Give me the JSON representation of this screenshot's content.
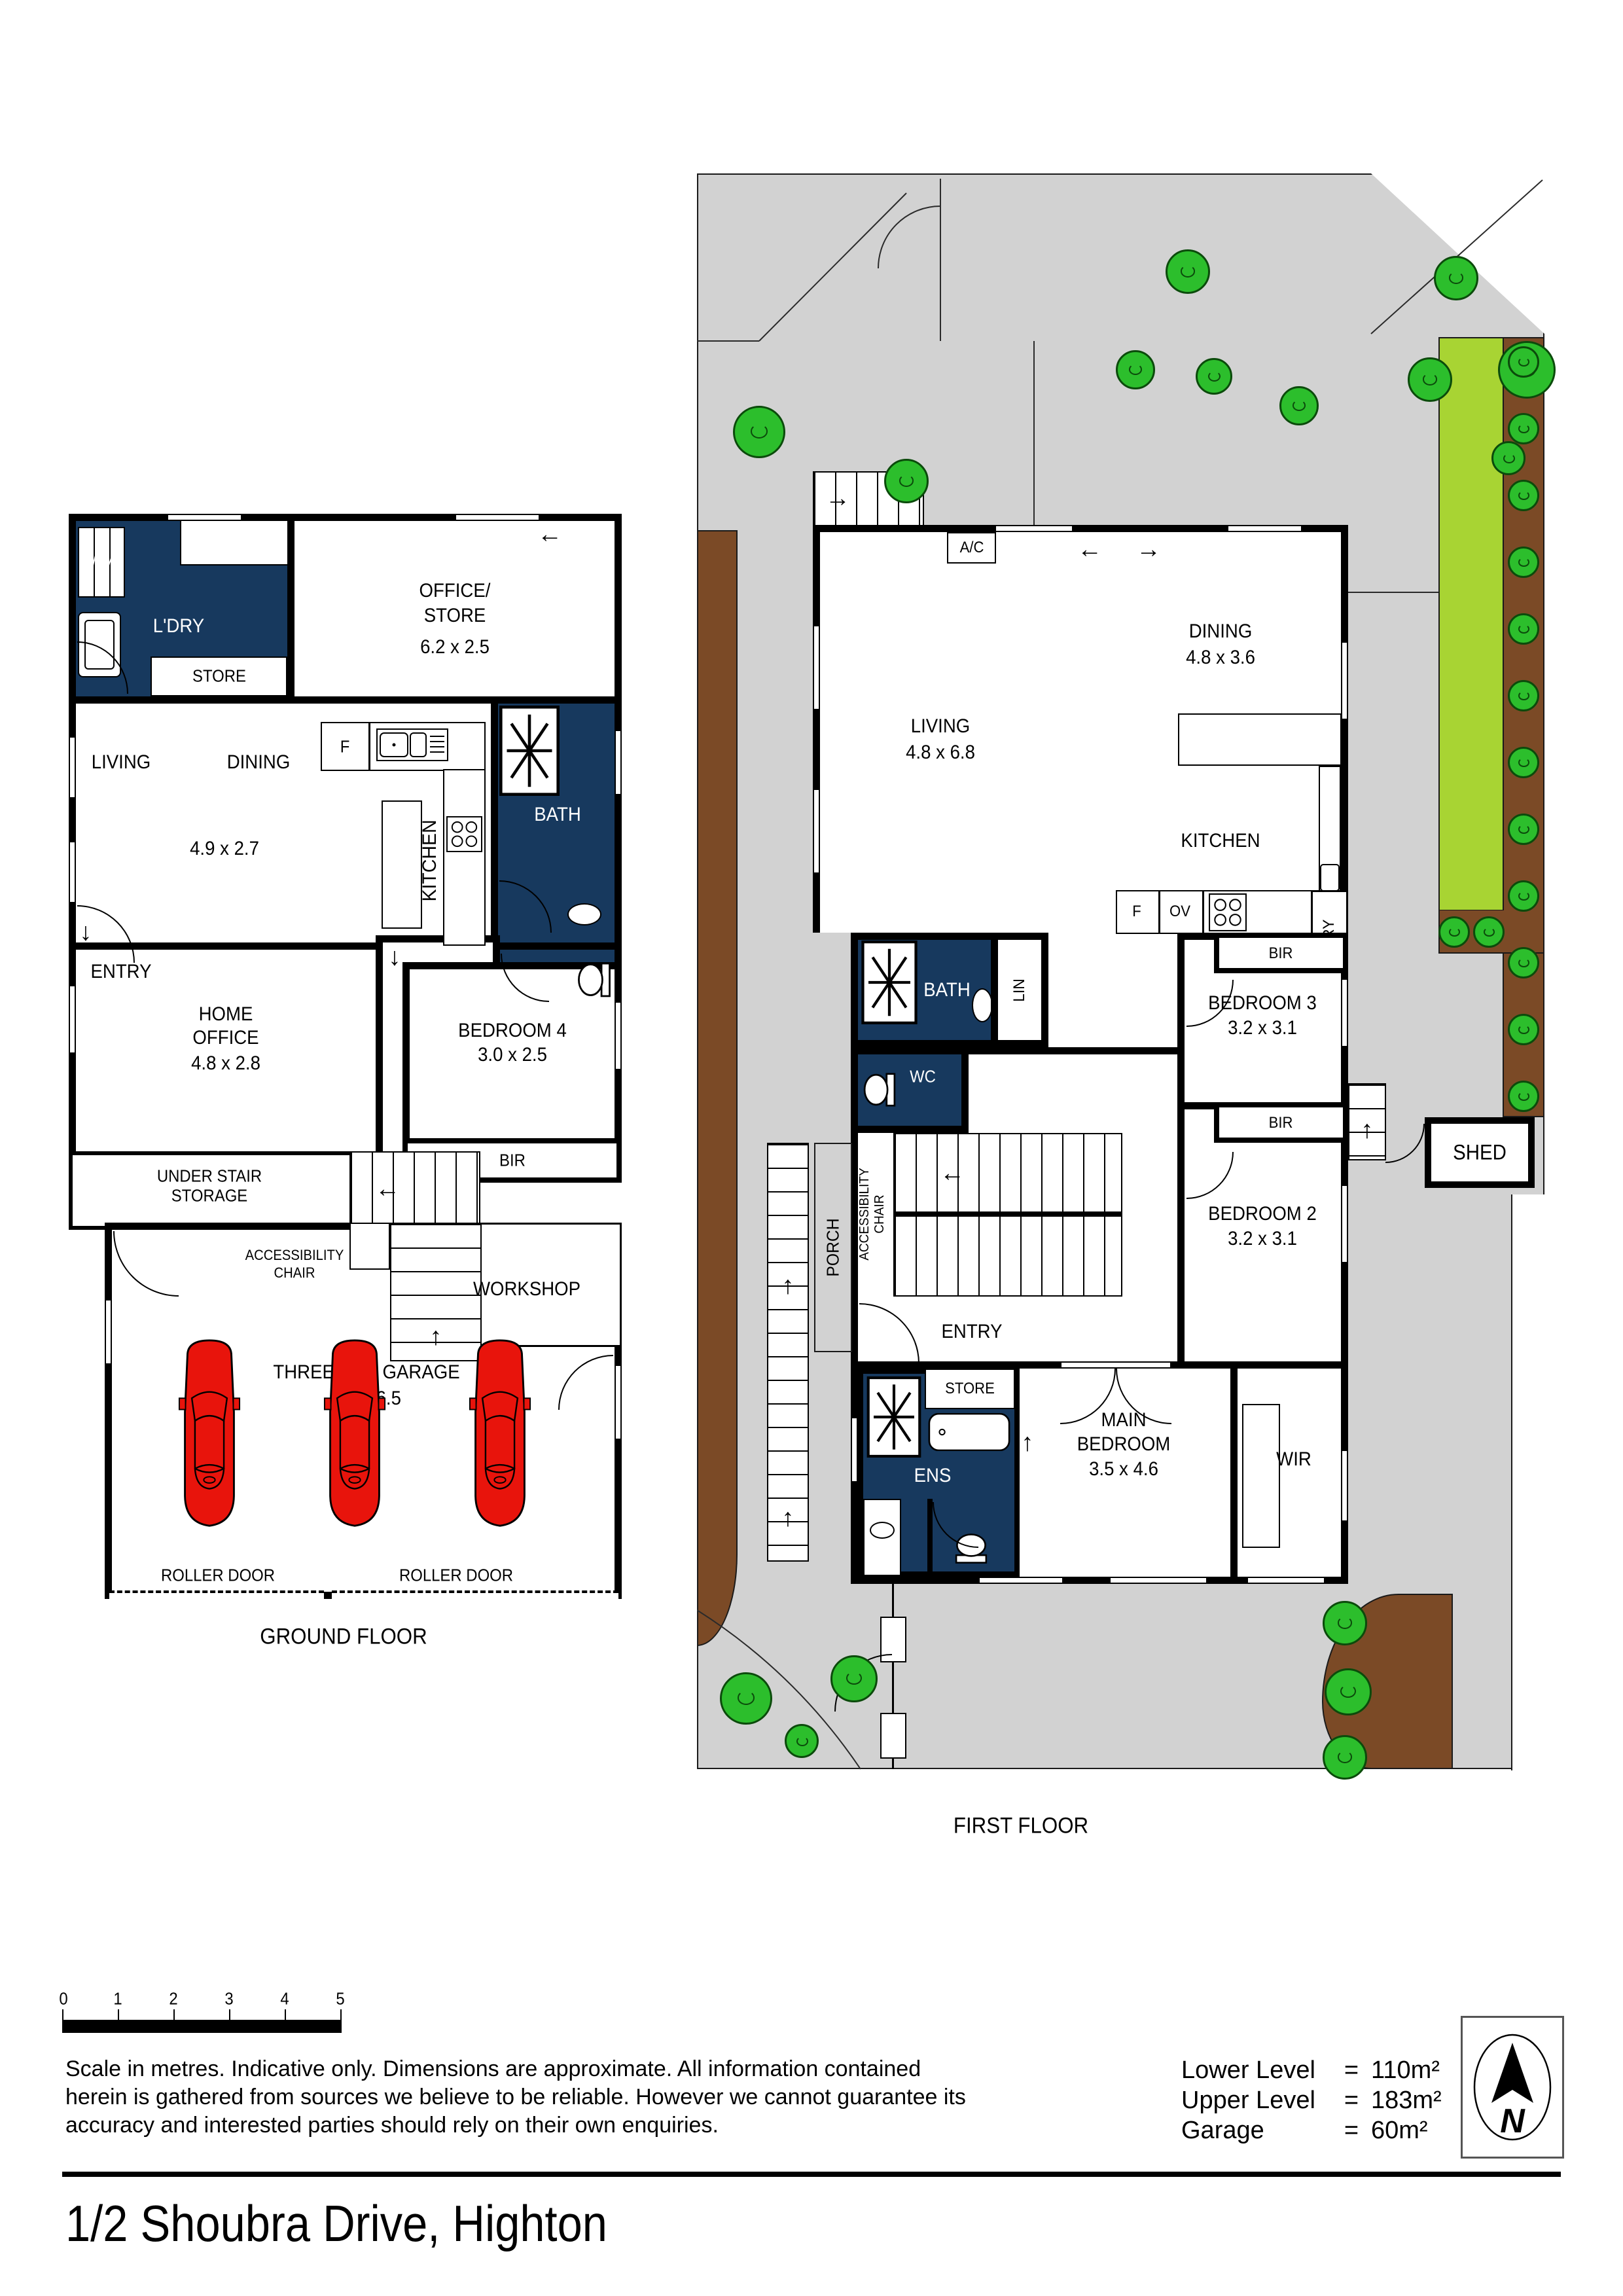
{
  "ground_floor": {
    "floor_label": "GROUND FLOOR",
    "wm": "WM",
    "laundry": "L'DRY",
    "store_laundry": "STORE",
    "office_store_l1": "OFFICE/",
    "office_store_l2": "STORE",
    "office_store_dims": "6.2 x 2.5",
    "fridge": "F",
    "kitchen": "KITCHEN",
    "bath": "BATH",
    "living": "LIVING",
    "dining": "DINING",
    "living_dining_dims": "4.9 x 2.7",
    "entry": "ENTRY",
    "home_office_l1": "HOME",
    "home_office_l2": "OFFICE",
    "home_office_dims": "4.8 x 2.8",
    "bedroom4": "BEDROOM 4",
    "bedroom4_dims": "3.0 x 2.5",
    "bir": "BIR",
    "under_stair_l1": "UNDER STAIR",
    "under_stair_l2": "STORAGE",
    "accessibility_l1": "ACCESSIBILITY",
    "accessibility_l2": "CHAIR",
    "workshop": "WORKSHOP",
    "garage": "THREE CAR GARAGE",
    "garage_dims": "8.0 x 6.5",
    "roller_door_left": "ROLLER DOOR",
    "roller_door_right": "ROLLER DOOR"
  },
  "first_floor": {
    "floor_label": "FIRST FLOOR",
    "ac": "A/C",
    "dining": "DINING",
    "dining_dims": "4.8 x 3.6",
    "living": "LIVING",
    "living_dims": "4.8 x 6.8",
    "kitchen": "KITCHEN",
    "dw": "DW",
    "pantry": "P'TRY",
    "fridge": "F",
    "oven": "OV",
    "bir_top": "BIR",
    "bir_bottom": "BIR",
    "bath": "BATH",
    "linen": "LIN",
    "wc": "WC",
    "bedroom3": "BEDROOM 3",
    "bedroom3_dims": "3.2 x 3.1",
    "bedroom2": "BEDROOM 2",
    "bedroom2_dims": "3.2 x 3.1",
    "accessibility_l1": "ACCESSIBILITY",
    "accessibility_l2": "CHAIR",
    "porch": "PORCH",
    "entry": "ENTRY",
    "store": "STORE",
    "ens": "ENS",
    "main_bedroom_l1": "MAIN",
    "main_bedroom_l2": "BEDROOM",
    "main_bedroom_dims": "3.5 x 4.6",
    "wir": "WIR",
    "shed": "SHED"
  },
  "footer": {
    "scale_ticks": [
      "0",
      "1",
      "2",
      "3",
      "4",
      "5"
    ],
    "disclaimer_l1": "Scale in metres. Indicative only. Dimensions are approximate. All information contained",
    "disclaimer_l2": "herein is gathered from sources we believe to be reliable. However we cannot guarantee its",
    "disclaimer_l3": "accuracy and interested parties should rely on their own enquiries.",
    "areas": [
      {
        "label": "Lower Level",
        "eq": "=",
        "value": "110m²"
      },
      {
        "label": "Upper Level",
        "eq": "=",
        "value": "183m²"
      },
      {
        "label": "Garage",
        "eq": "=",
        "value": "60m²"
      }
    ],
    "north_letter": "N",
    "address": "1/2 Shoubra Drive, Highton"
  },
  "icons": {
    "up_arrow": "↑",
    "down_arrow": "↓",
    "left_arrow": "←",
    "right_arrow": "→"
  },
  "colors": {
    "wet_area": "#17395E",
    "car": "#E8140C",
    "tree": "#2CBE2C",
    "lawn": "#A8D433",
    "garden_bed": "#7B4A26",
    "paving": "#D2D2D2"
  }
}
